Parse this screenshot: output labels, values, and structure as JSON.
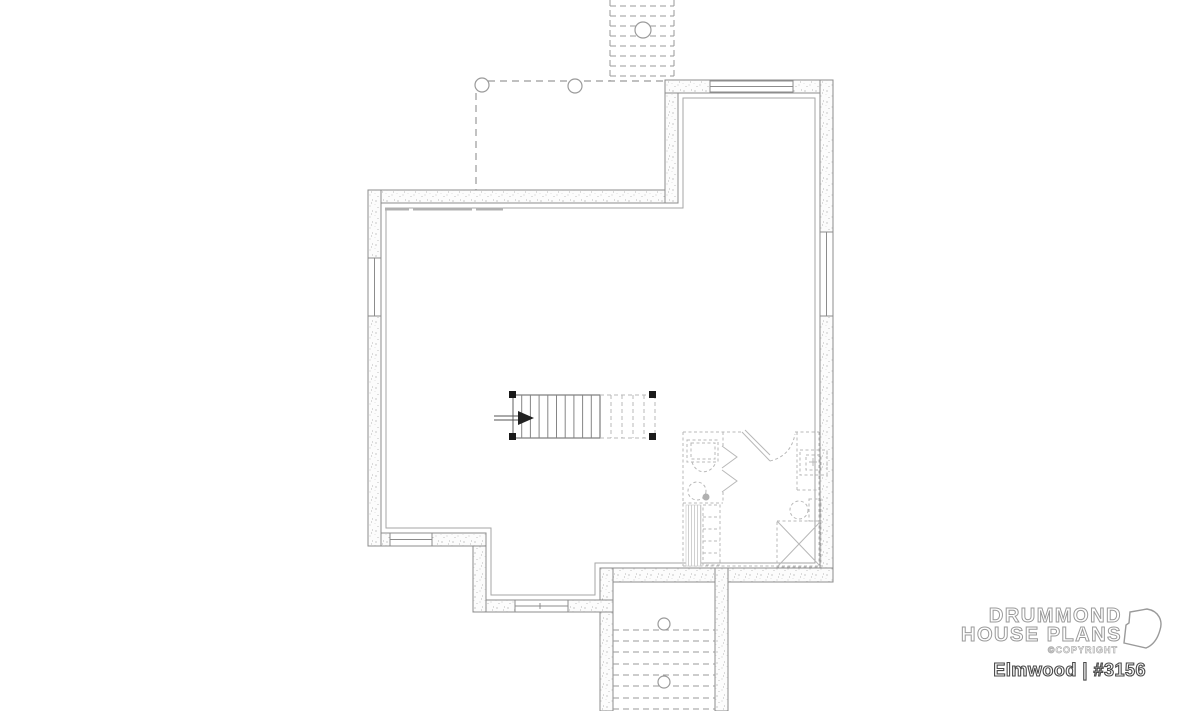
{
  "branding": {
    "name_line1": "DRUMMOND",
    "name_line2": "HOUSE PLANS",
    "copyright": "©COPYRIGHT",
    "plan_title": "Elmwood | #3156"
  },
  "colors": {
    "background": "#ffffff",
    "wall-line": "#8c8c8c",
    "dash-line": "#9a9a9a",
    "fixture-line": "#b8b8b8",
    "stair-line": "#858585",
    "post-black": "#1a1a1a",
    "logo-outline": "#9a9a9a",
    "title-outline": "#4a4a4a"
  }
}
